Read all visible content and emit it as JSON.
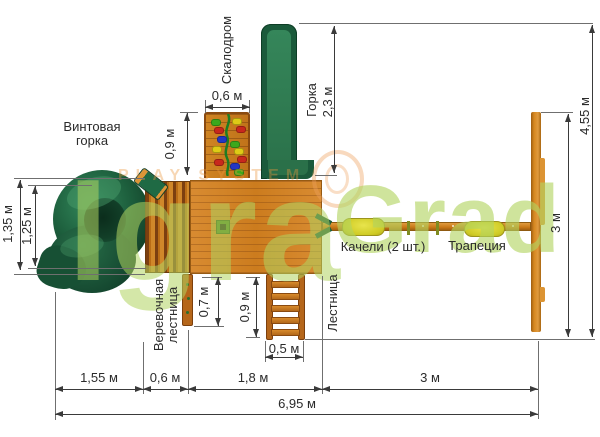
{
  "equipment": {
    "spiral_slide": "Винтовая\nгорка",
    "climbing_wall": "Скалодром",
    "slide": "Горка",
    "swings": "Качели (2 шт.)",
    "trapeze": "Трапеция",
    "rope_ladder_line1": "Веревочная",
    "rope_ladder_line2": "лестница",
    "ladder": "Лестница"
  },
  "dimensions": {
    "climbing_wall_width": "0,6 м",
    "climbing_wall_height": "0,9 м",
    "slide_length": "2,3 м",
    "spiral_footprint": "1,35 м",
    "spiral_inner": "1,25 м",
    "rope_ladder_length": "0,7 м",
    "ladder_length": "0,9 м",
    "ladder_width": "0,5 м",
    "section_spiral": "1,55 м",
    "section_bridge": "0,6 м",
    "section_platform": "1,8 м",
    "section_swings": "3 м",
    "total_length": "6,95 м",
    "total_depth": "4,55 м",
    "swing_frame_depth": "3 м"
  },
  "watermark": {
    "brand_first": "Igra",
    "brand_second": "Grad",
    "overlay_text": "PLAY SYSTEM"
  },
  "colors": {
    "wood": "#d28326",
    "wood_dark": "#8a4a14",
    "slide_green": "#1d5e3e",
    "slide_channel": "#2e7e53",
    "seat_yellow": "#d8d831",
    "watermark_green": "#b1d460",
    "dimension_line": "#3a3a3a",
    "hold_red": "#c8281c",
    "hold_blue": "#2336c4",
    "hold_yellow": "#decb16",
    "hold_green": "#3da81c"
  }
}
